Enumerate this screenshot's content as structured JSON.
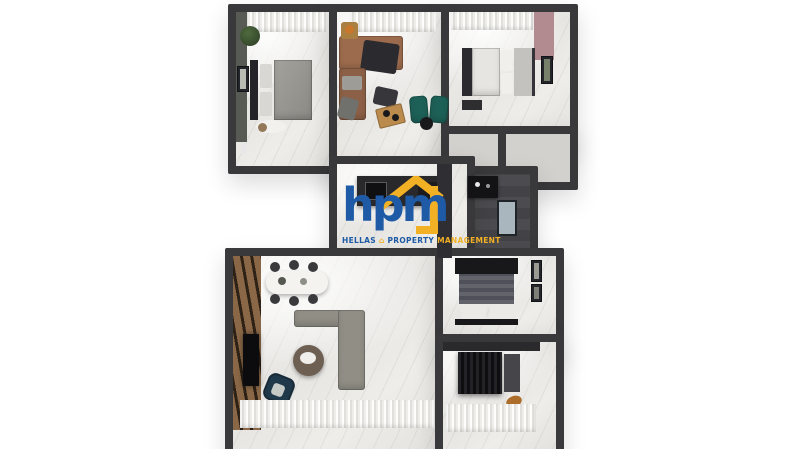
{
  "scene": {
    "description": "3D top-down architectural render of an apartment floor plan on a white background with agency watermark",
    "watermark_present": true
  },
  "watermark": {
    "monogram": "hpm",
    "words": {
      "first": "HELLAS",
      "second": "PROPERTY",
      "third": "MANAGEMENT"
    },
    "house_glyph": "⌂",
    "colors": {
      "blue": "#1e5aa5",
      "yellow": "#f2b024"
    }
  },
  "palette": {
    "background": "#ffffff",
    "walls": "#39393b",
    "marble_floor": "#edecea",
    "dark_tile_floor": "#4b4b4e",
    "wood_slat_wall": "#8a6847",
    "copper_sofa": "#9c6b4d",
    "teal_armchairs": "#1d6057",
    "gray_sofa": "#908e85",
    "navy_armchair": "#20394a",
    "accent_pink_wall": "#b18b90"
  },
  "rooms": [
    {
      "name": "bedroom-top-left",
      "furniture": [
        "double bed",
        "potted plant",
        "wall art",
        "stool",
        "rug"
      ]
    },
    {
      "name": "lounge-top-middle",
      "furniture": [
        "copper corner sofa with dark throw",
        "floor chair",
        "pouf",
        "wood tray table",
        "two teal armchairs",
        "round side table"
      ]
    },
    {
      "name": "bedroom-top-right",
      "furniture": [
        "double bed",
        "wall art",
        "nightstand",
        "pink accent wall"
      ]
    },
    {
      "name": "closets-mid-right",
      "furniture": []
    },
    {
      "name": "bathroom-mid-right",
      "furniture": [
        "black vanity",
        "shower tray"
      ]
    },
    {
      "name": "hallway-kitchen-center",
      "furniture": [
        "counter with sink",
        "cooktop",
        "tall cabinet"
      ]
    },
    {
      "name": "living-room-bottom-left",
      "furniture": [
        "dining table with six chairs",
        "gray corner sofa",
        "round coffee table",
        "navy armchair",
        "TV on wood slat wall"
      ]
    },
    {
      "name": "bedroom-bottom-right",
      "furniture": [
        "double bed with two pillows",
        "wall art"
      ]
    },
    {
      "name": "dressing-room-bottom-right",
      "furniture": [
        "ribbed wardrobe",
        "cabinet",
        "cat"
      ]
    }
  ]
}
